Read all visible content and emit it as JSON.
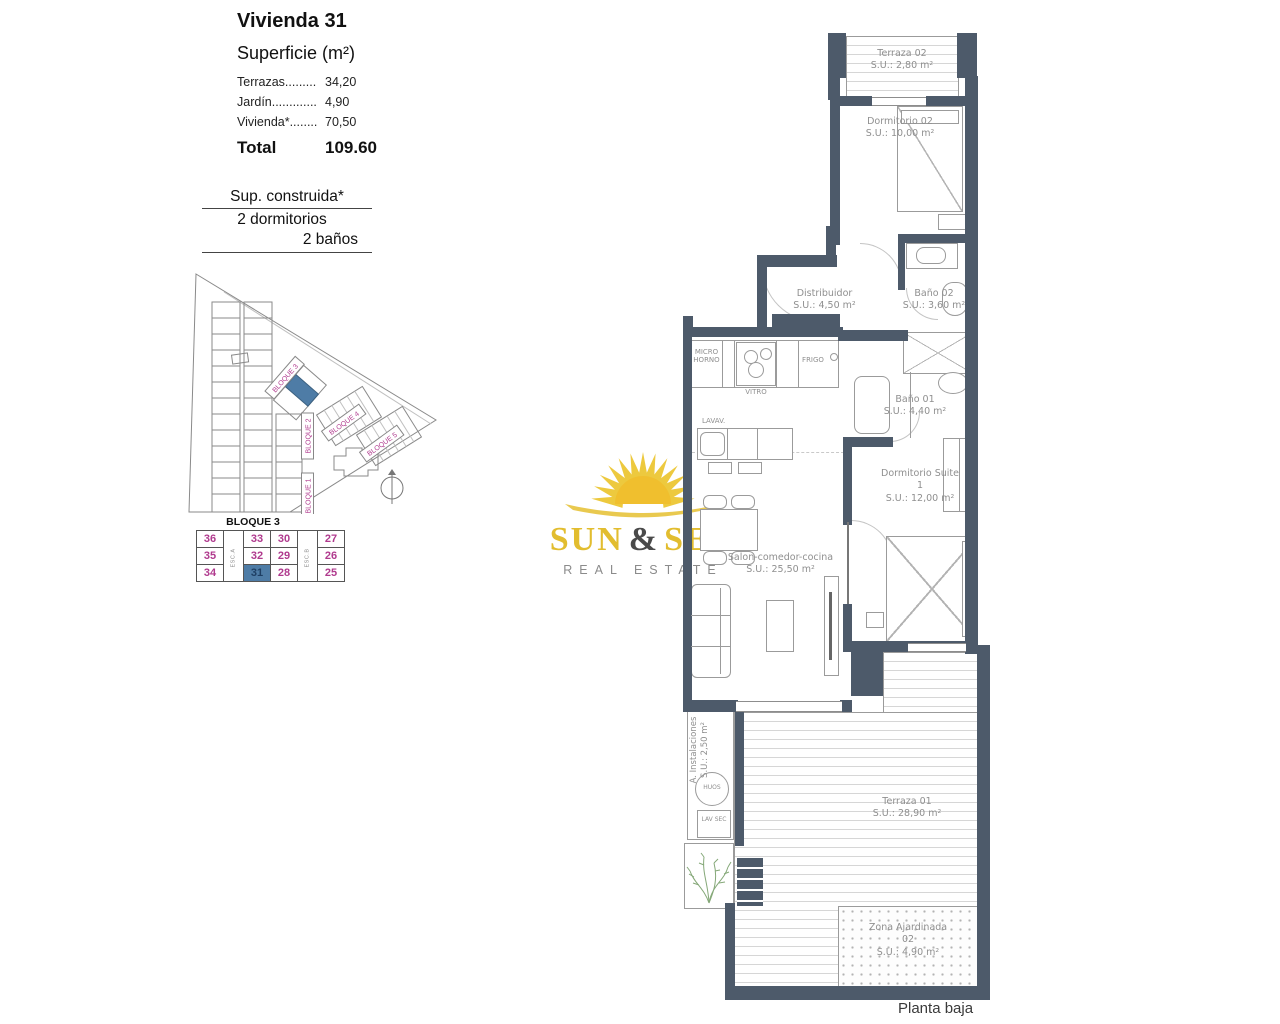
{
  "info_panel": {
    "title": "Vivienda 31",
    "subtitle": "Superficie (m²)",
    "rows": [
      {
        "label": "Terrazas.........",
        "value": "34,20"
      },
      {
        "label": "Jardín.............",
        "value": "4,90"
      },
      {
        "label": "Vivienda*........",
        "value": "70,50"
      }
    ],
    "total_label": "Total",
    "total_value": "109.60"
  },
  "construida": {
    "line1": "Sup. construida*",
    "line2": "2 dormitorios",
    "line3": "2 baños"
  },
  "site_plan": {
    "bloque1": "BLOQUE 1",
    "bloque2": "BLOQUE 2",
    "bloque3": "BLOQUE 3",
    "bloque4": "BLOQUE 4",
    "bloque5": "BLOQUE 5"
  },
  "block_table": {
    "title": "BLOQUE 3",
    "esc_a": "ESC.A",
    "esc_b": "ESC.B",
    "rows": [
      [
        "36",
        "33",
        "30",
        "27"
      ],
      [
        "35",
        "32",
        "29",
        "26"
      ],
      [
        "34",
        "31",
        "28",
        "25"
      ]
    ],
    "highlighted_unit": "31",
    "number_color": "#b03a8e",
    "highlight_color": "#4e7ca6"
  },
  "logo": {
    "word1": "SUN",
    "amp": "&",
    "word2": "SEA",
    "subtitle": "REAL ESTATE",
    "yellow": "#e2bd2f"
  },
  "plan": {
    "rooms": [
      {
        "name": "Terraza 02",
        "area": "S.U.: 2,80 m²"
      },
      {
        "name": "Dormitorio 02",
        "area": "S.U.: 10,00 m²"
      },
      {
        "name": "Distribuidor",
        "area": "S.U.: 4,50 m²"
      },
      {
        "name": "Baño 02",
        "area": "S.U.: 3,60 m²"
      },
      {
        "name": "Baño 01",
        "area": "S.U.: 4,40 m²"
      },
      {
        "name": "Dormitorio Suite 1",
        "area": "S.U.: 12,00 m²"
      },
      {
        "name": "Salon-comedor-cocina",
        "area": "S.U.: 25,50 m²"
      },
      {
        "name": "A. Instalaciones",
        "area": "S.U.: 2,50 m²"
      },
      {
        "name": "Terraza 01",
        "area": "S.U.: 28,90 m²"
      },
      {
        "name": "Zona Ajardinada 02",
        "area": "S.U.: 4,90 m²"
      }
    ],
    "appliances": {
      "micro": "MICRO HORNO",
      "vitro": "VITRO",
      "frigo": "FRIGO",
      "lavav": "LAVAV.",
      "huos": "HUOS",
      "lavsec": "LAV SEC"
    },
    "wall_color": "#4d5a6a"
  },
  "footer": {
    "caption": "Planta baja"
  }
}
